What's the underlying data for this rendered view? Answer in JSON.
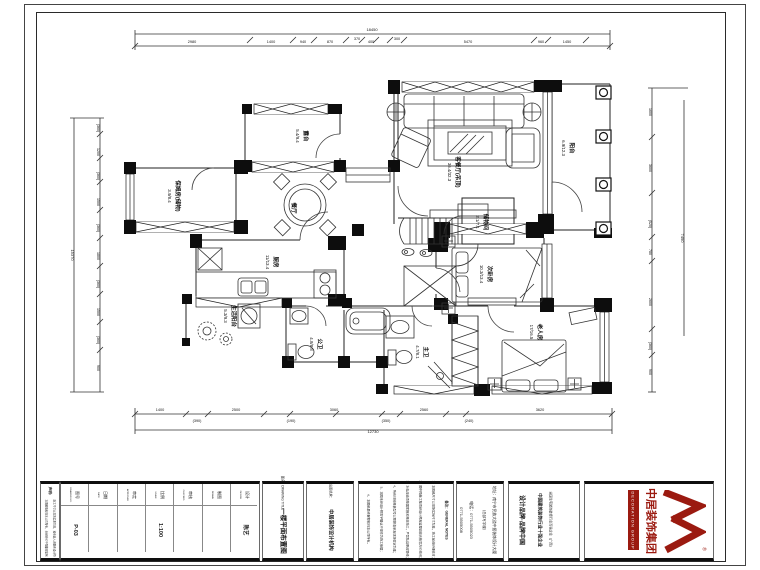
{
  "plan": {
    "rooms": [
      {
        "name": "客餐厅(吊顶)",
        "dims": "36.4/32.3",
        "x": 452,
        "y": 172
      },
      {
        "name": "阳台",
        "dims": "6.9/12.3",
        "x": 566,
        "y": 148
      },
      {
        "name": "露台",
        "dims": "5.4/9.4",
        "x": 300,
        "y": 136
      },
      {
        "name": "保姆房(储物)",
        "dims": "3.9/8.4",
        "x": 172,
        "y": 196
      },
      {
        "name": "餐厅",
        "dims": "",
        "x": 288,
        "y": 208
      },
      {
        "name": "厨房",
        "dims": "11/13.4",
        "x": 270,
        "y": 262
      },
      {
        "name": "生活阳台",
        "dims": "5.3/9.3",
        "x": 228,
        "y": 316
      },
      {
        "name": "公卫",
        "dims": "4.8/8.8",
        "x": 314,
        "y": 344
      },
      {
        "name": "储物间",
        "dims": "2.1/7.1",
        "x": 480,
        "y": 222
      },
      {
        "name": "次卧房",
        "dims": "10.3/13.4",
        "x": 484,
        "y": 274
      },
      {
        "name": "老人房",
        "dims": "17/16.5",
        "x": 534,
        "y": 332
      },
      {
        "name": "主卫",
        "dims": "4.7/8.1",
        "x": 420,
        "y": 352
      }
    ],
    "dims": {
      "top": {
        "total": {
          "t": "18450",
          "x": 372,
          "y": 31
        },
        "values": [
          {
            "t": "2980",
            "x": 192,
            "y": 43
          },
          {
            "t": "1400",
            "x": 271,
            "y": 43
          },
          {
            "t": "940",
            "x": 303,
            "y": 43
          },
          {
            "t": "870",
            "x": 330,
            "y": 43
          },
          {
            "t": "370",
            "x": 357,
            "y": 40
          },
          {
            "t": "400",
            "x": 371,
            "y": 43
          },
          {
            "t": "300",
            "x": 397,
            "y": 40
          },
          {
            "t": "5470",
            "x": 468,
            "y": 43
          },
          {
            "t": "960",
            "x": 541,
            "y": 43
          },
          {
            "t": "1450",
            "x": 567,
            "y": 43
          }
        ]
      },
      "bottom": {
        "total": {
          "t": "12730",
          "x": 373,
          "y": 433
        },
        "values": [
          {
            "t": "1400",
            "x": 160,
            "y": 411
          },
          {
            "t": "(390)",
            "x": 197,
            "y": 422
          },
          {
            "t": "2500",
            "x": 236,
            "y": 411
          },
          {
            "t": "(190)",
            "x": 291,
            "y": 422
          },
          {
            "t": "3060",
            "x": 334,
            "y": 411
          },
          {
            "t": "(350)",
            "x": 386,
            "y": 422
          },
          {
            "t": "2560",
            "x": 424,
            "y": 411
          },
          {
            "t": "(240)",
            "x": 469,
            "y": 422
          },
          {
            "t": "3620",
            "x": 540,
            "y": 411
          }
        ]
      },
      "left": {
        "total": {
          "t": "15370",
          "x": 71,
          "y": 255
        },
        "x": 97,
        "values": [
          {
            "t": "(360)",
            "y": 128
          },
          {
            "t": "1200",
            "y": 152
          },
          {
            "t": "(360)",
            "y": 176
          },
          {
            "t": "1500",
            "y": 202
          },
          {
            "t": "(360)",
            "y": 228
          },
          {
            "t": "1800",
            "y": 256
          },
          {
            "t": "(360)",
            "y": 284
          },
          {
            "t": "1500",
            "y": 312
          },
          {
            "t": "(360)",
            "y": 340
          },
          {
            "t": "900",
            "y": 368
          }
        ]
      },
      "right": {
        "total": {
          "t": "7490",
          "x": 681,
          "y": 238
        },
        "x": 649,
        "values": [
          {
            "t": "1600",
            "y": 112
          },
          {
            "t": "3600",
            "y": 168
          },
          {
            "t": "(520)",
            "y": 224
          },
          {
            "t": "780",
            "y": 252
          },
          {
            "t": "2600",
            "y": 302
          },
          {
            "t": "(360)",
            "y": 346
          },
          {
            "t": "900",
            "y": 372
          }
        ]
      }
    }
  },
  "title_block": {
    "sign": {
      "header": {
        "t": "声明：",
        "x": 49,
        "y": 492
      },
      "lines": [
        {
          "t": "本图纸版权归本公司所有，未经许可不得翻印复制",
          "x": 45,
          "y": 528
        },
        {
          "t": "施工尺寸以现场实测为准，如有出入请联系设计师",
          "x": 53,
          "y": 528
        }
      ]
    },
    "fields": {
      "label_y": 495,
      "value_y": 530,
      "items": [
        {
          "label": "图号",
          "en": "DRAWING NO.",
          "value": "P-03",
          "x": 74
        },
        {
          "label": "日期",
          "en": "DATE",
          "value": "",
          "x": 102
        },
        {
          "label": "审定",
          "en": "APPROVED",
          "value": "",
          "x": 131
        },
        {
          "label": "比例",
          "en": "SCALE",
          "value": "1:100",
          "x": 159
        },
        {
          "label": "审核",
          "en": "CHECKED",
          "value": "",
          "x": 187
        },
        {
          "label": "制图",
          "en": "DRAWN",
          "value": "",
          "x": 216
        },
        {
          "label": "设计",
          "en": "DESIGN",
          "value": "陈艺",
          "x": 244
        }
      ]
    },
    "drawing_title": {
      "header": "图名：DRAWING TITLE",
      "title": "一楼平面布置图",
      "x": 282
    },
    "agency": {
      "header": "出图机构：",
      "name": "中居装饰设计机构",
      "x": 330
    },
    "notes": {
      "header": {
        "t": "备注：GENERAL NOTES",
        "x": 446,
        "y": 520
      },
      "lines": [
        {
          "t": "1、本图纸尺寸以现场实际尺寸为准，施工前请仔细核对；",
          "x": 433
        },
        {
          "t": "2、图中隐蔽工程须经设计师及监理验收合格后方可封闭；",
          "x": 420
        },
        {
          "t": "3、水电改造须按国家相关规范施工，严禁私自更改管线；",
          "x": 407
        },
        {
          "t": "4、所有材料规格型号以预算清单及现场签定为准；",
          "x": 394
        },
        {
          "t": "5、本图未经设计师签字确认不得作为施工依据；",
          "x": 381
        },
        {
          "t": "6、本图纸最终解释权归本公司所有。",
          "x": 368
        }
      ]
    },
    "contact": {
      "lines": [
        {
          "t": "地址：南宁市民族大道中居装饰设计大厦",
          "x": 493,
          "s": 3.8
        },
        {
          "t": "（总部写字楼）",
          "x": 483,
          "s": 3.5
        },
        {
          "t": "电话：0771-5505023",
          "x": 471,
          "s": 4
        },
        {
          "t": "0771-5505008",
          "x": 461,
          "s": 4
        }
      ]
    },
    "brand": {
      "lines": [
        {
          "t": "设计品牌·品牌中国",
          "x": 521,
          "s": 6,
          "b": 1
        },
        {
          "t": "中国建筑装饰行业十强企业",
          "x": 539,
          "s": 4.5,
          "b": 1
        },
        {
          "t": "全国住宅装饰装修行业百强企业（广西）",
          "x": 550,
          "s": 3.2,
          "b": 0
        }
      ]
    },
    "logo": {
      "company": "中居装饰集团",
      "banner": "DECORATION GROUP",
      "registered": "®",
      "color": "#9b1a10"
    }
  }
}
